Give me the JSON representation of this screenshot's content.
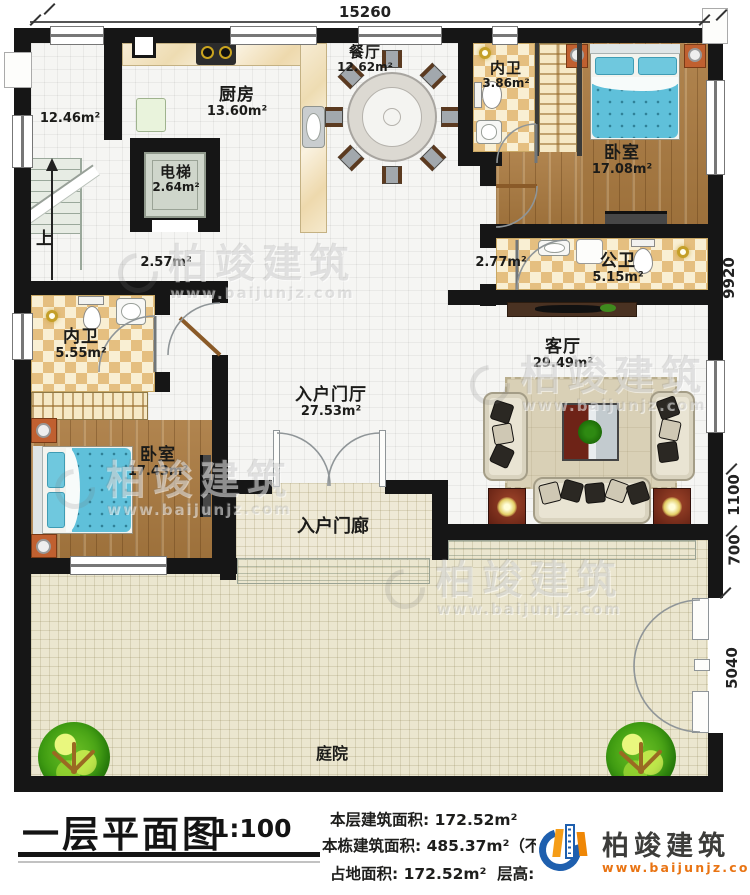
{
  "plan": {
    "dim_top": "15260",
    "dim_right_1": "9920",
    "dim_right_2": "1100",
    "dim_right_3": "700",
    "dim_right_4": "5040",
    "stairs_up": "上",
    "rooms": {
      "stair_hall": {
        "area": "12.46m²"
      },
      "kitchen": {
        "name": "厨房",
        "area": "13.60m²"
      },
      "dining": {
        "name": "餐厅",
        "area": "12.62m²"
      },
      "elevator": {
        "name": "电梯",
        "area": "2.64m²"
      },
      "ensuite_top": {
        "name": "内卫",
        "area": "3.86m²"
      },
      "bedroom_right": {
        "name": "卧室",
        "area": "17.08m²"
      },
      "public_bath": {
        "name": "公卫",
        "area": "5.15m²"
      },
      "corridor_a": {
        "area": "2.57m²"
      },
      "corridor_b": {
        "area": "2.77m²"
      },
      "ensuite_left": {
        "name": "内卫",
        "area": "5.55m²"
      },
      "bedroom_left": {
        "name": "卧室",
        "area": "17.43m²"
      },
      "foyer": {
        "name": "入户门厅",
        "area": "27.53m²"
      },
      "living": {
        "name": "客厅",
        "area": "29.49m²"
      },
      "porch": {
        "name": "入户门廊"
      },
      "courtyard": {
        "name": "庭院"
      }
    }
  },
  "watermark": {
    "name": "柏竣建筑",
    "url": "www.baijunjz.com"
  },
  "title_block": {
    "title": "一层平面图",
    "scale": "1:100"
  },
  "info": {
    "row1_label": "本层建筑面积:",
    "row1_value": "172.52m²",
    "row2_label": "本栋建筑面积:",
    "row2_value": "485.37m²（不含庭院面积）",
    "row3a_label": "占地面积:",
    "row3a_value": "172.52m²",
    "row3b_label": "层高:",
    "row3b_value": "3.6m"
  },
  "brand": {
    "name": "柏竣建筑",
    "url": "www.baijunjz.com"
  }
}
